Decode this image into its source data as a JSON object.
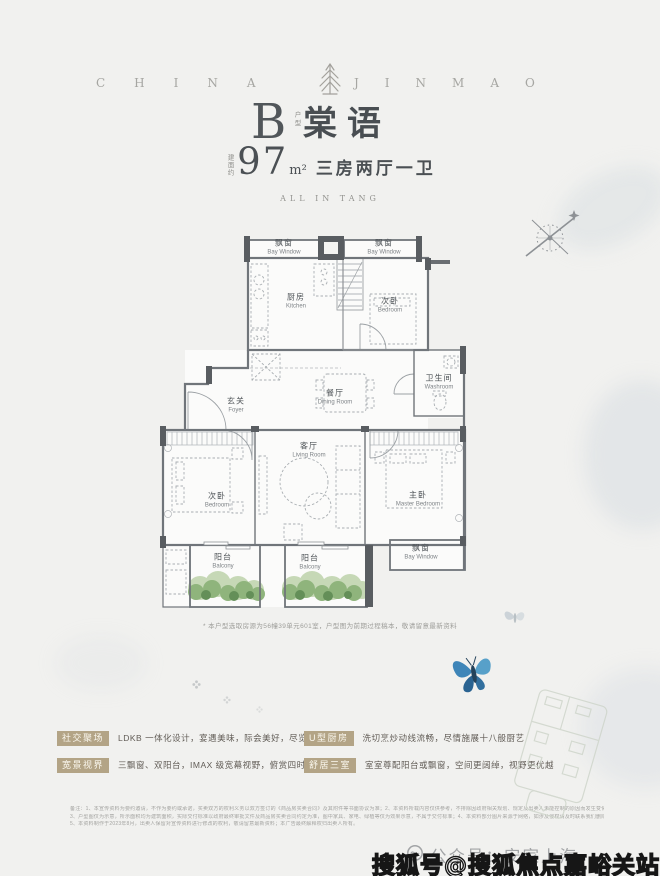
{
  "brand": {
    "wordmark_left": "CHINA",
    "wordmark_right": "JINMAO",
    "logo": "jinmao-tree-logo"
  },
  "title": {
    "type_letter": "B",
    "type_side_label": "户型",
    "name": "棠语",
    "area_side_label": "建面约",
    "area_number": "97",
    "area_unit": "m²",
    "area_desc": "三房两厅一卫",
    "tagline": "ALL IN TANG"
  },
  "floorplan": {
    "compass": "compass-rose",
    "rooms": {
      "bay_window_top_left": {
        "cn": "飘窗",
        "en": "Bay Window"
      },
      "bay_window_top_right": {
        "cn": "飘窗",
        "en": "Bay Window"
      },
      "kitchen": {
        "cn": "厨房",
        "en": "Kitchen"
      },
      "bedroom_top": {
        "cn": "次卧",
        "en": "Bedroom"
      },
      "washroom": {
        "cn": "卫生间",
        "en": "Washroom"
      },
      "foyer": {
        "cn": "玄关",
        "en": "Foyer"
      },
      "dining_room": {
        "cn": "餐厅",
        "en": "Dining Room"
      },
      "living_room": {
        "cn": "客厅",
        "en": "Living Room"
      },
      "bedroom_left": {
        "cn": "次卧",
        "en": "Bedroom"
      },
      "master_bedroom": {
        "cn": "主卧",
        "en": "Master Bedroom"
      },
      "balcony_left": {
        "cn": "阳台",
        "en": "Balcony"
      },
      "balcony_center": {
        "cn": "阳台",
        "en": "Balcony"
      },
      "bay_window_bottom_right": {
        "cn": "飘窗",
        "en": "Bay Window"
      }
    },
    "note": "* 本户型选取房源为56幢39单元601室，户型图为前期过程稿本，敬请留意最新资料"
  },
  "features": [
    {
      "tag": "社交聚场",
      "text": "LDKB 一体化设计，宴遇美味，际会美好，尽览美景"
    },
    {
      "tag": "U型厨房",
      "text": "洗切烹炒动线流畅，尽情施展十八般厨艺"
    },
    {
      "tag": "宽景视界",
      "text": "三飘窗、双阳台，IMAX 级宽幕视野，俯赏四时风光"
    },
    {
      "tag": "舒居三室",
      "text": "室室尊配阳台或飘窗，空间更阔绰，视野更优越"
    }
  ],
  "legal": {
    "line1": "备注：1、本宣传资料为要约邀请，不作为要约或承诺，买卖双方的权利义务以双方签订的《商品房买卖合同》及其附件等书面协议为准；2、本资料所载内容仅供参考，不排除因政府相关规划、规定及出卖人未能控制的原因而发生变化；",
    "line2": "3、户型图仅为示意，所示面积均为建筑面积，实际交付标准以政府最终审批文件及商品房买卖合同约定为准，图中家具、家电、绿植等仅为效果示意，不属于交付标准；4、本资料部分图片来源于网络，如涉及侵权请及时联系我们删除；",
    "line3": "5、本资料制作于2023年8月，出卖人保留对宣传资料进行修改的权利，敬请留意最新资料；本广告最终解释权归出卖人所有。"
  },
  "watermarks": {
    "wechat": "公众号：安家上海",
    "sohu": "搜狐号@搜狐焦点嘉峪关站"
  },
  "colors": {
    "tag_bg": "#b3a486",
    "wall": "#70757a",
    "green": "#8fb47c",
    "butterfly_blue": "#3e85b8"
  }
}
